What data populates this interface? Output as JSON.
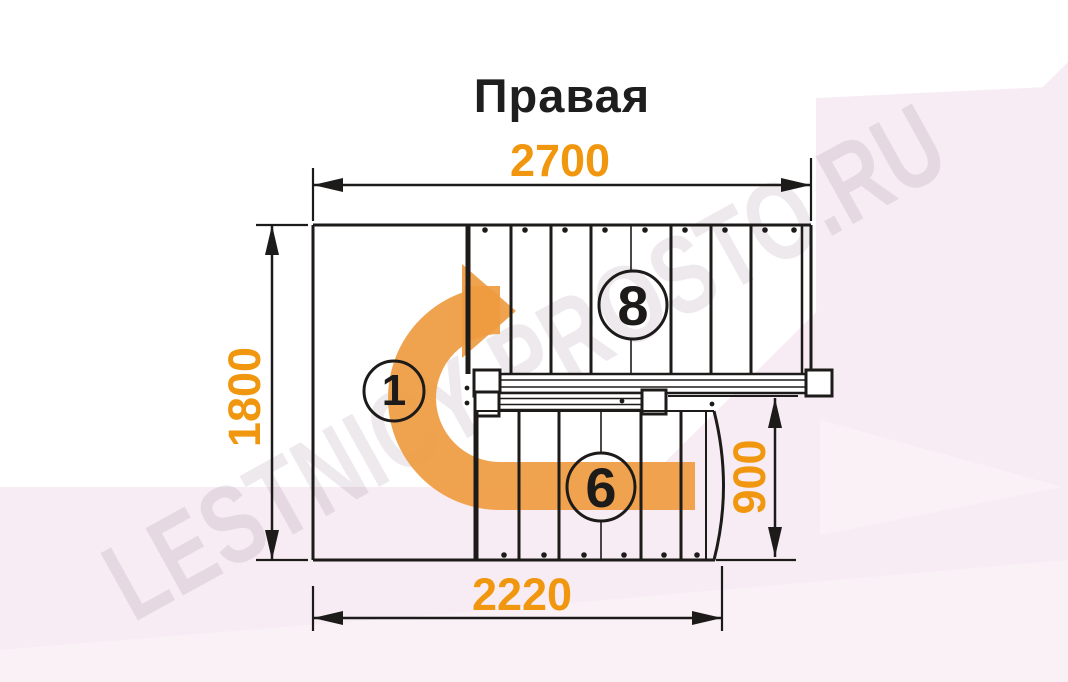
{
  "title": "Правая",
  "watermark_text": "LESTNICY-PROSTO.RU",
  "dimensions": {
    "width_top": "2700",
    "height_left": "1800",
    "height_right": "900",
    "width_bottom": "2220"
  },
  "labels": {
    "upper_flight_steps": "8",
    "first_step": "1",
    "lower_flight_steps": "6"
  },
  "colors": {
    "dimension_text": "#F0970F",
    "arrow": "#EF9B40",
    "linework": "#1D1B1A",
    "title": "#1E1E1E",
    "background_tint": "#F7ECF4",
    "watermark": "rgba(126,98,124,0.14)"
  }
}
